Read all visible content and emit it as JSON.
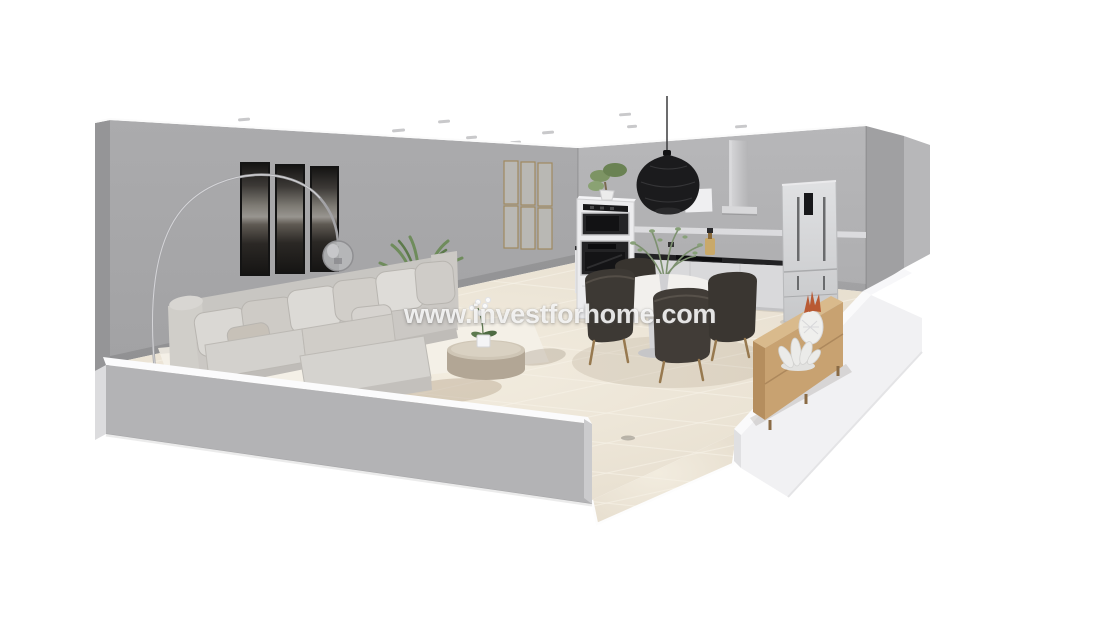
{
  "watermark": {
    "text": "www.investforhome.com"
  },
  "scene": {
    "type": "3d-cutaway-floor-plan-render",
    "areas": [
      "living-room",
      "dining-area",
      "kitchen"
    ],
    "dining_chairs": 4,
    "wall_art_panels": 3,
    "wall_decor_frames": 6,
    "objects": [
      "sectional-sofa",
      "throw-pillows",
      "arc-floor-lamp",
      "triptych-wall-art",
      "potted-palm",
      "round-coffee-table",
      "orchid-plant",
      "area-rug",
      "wall-slat-decor",
      "tall-oven-cabinet",
      "built-in-microwave",
      "built-in-oven",
      "bonsai-plant",
      "pendant-light",
      "range-hood",
      "wall-shelf",
      "kitchen-counter",
      "cooktop",
      "oil-bottle",
      "refrigerator",
      "round-dining-table",
      "eucalyptus-centerpiece",
      "dining-chairs",
      "wooden-sideboard",
      "pineapple-ornament",
      "coral-ornament",
      "ceiling-spotlights",
      "tiled-floor",
      "cutaway-walls",
      "door-opening"
    ]
  },
  "colors": {
    "background": "#ffffff",
    "wall_main": "#a7a7a9",
    "wall_kitchen": "#b2b2b4",
    "wall_cutaway_white": "#f1f1f3",
    "wall_cutaway_gray": "#b3b3b5",
    "floor_tile": "#e9e1d3",
    "rug": "#f4f0e7",
    "sofa": "#cecbc7",
    "dining_chair": "#3d3934",
    "wood_sideboard": "#c8a271",
    "wood_leg": "#97794f",
    "appliance_black": "#1e1e20",
    "fridge": "#d3d4d6",
    "pendant_black": "#1b1b1d",
    "plant_green": "#6f8c5c",
    "pineapple_accent": "#b95a33",
    "watermark_white": "#ffffff"
  }
}
